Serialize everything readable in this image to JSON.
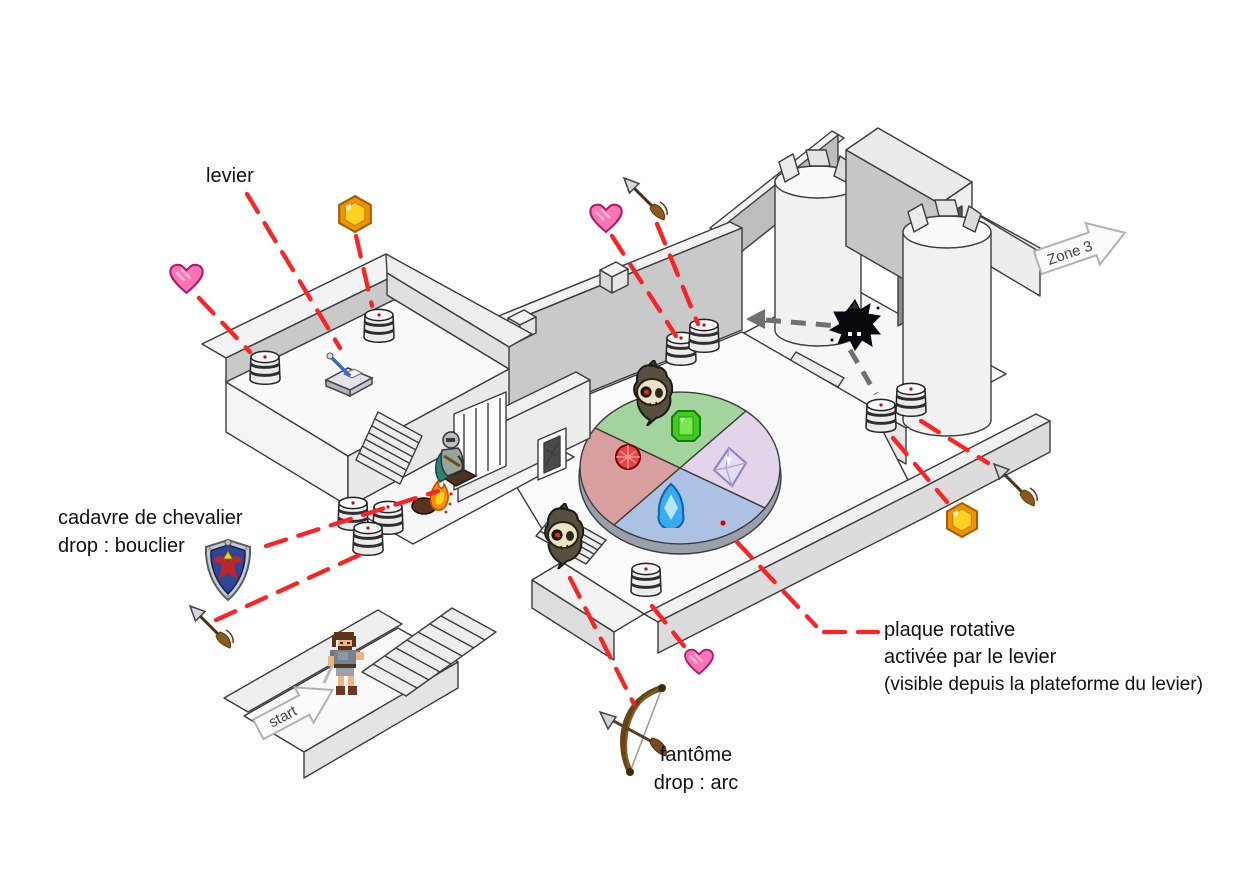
{
  "labels": {
    "lever_label": "levier",
    "knight_label_line1": "cadavre de chevalier",
    "knight_label_line2": "drop : bouclier",
    "ghost_label_line1": "fantôme",
    "ghost_label_line2": "drop : arc",
    "plate_label_line1": "plaque rotative",
    "plate_label_line2": "activée par le levier",
    "plate_label_line3": "(visible depuis la plateforme du levier)",
    "zone3_arrow": "Zone 3",
    "start_arrow": "start"
  },
  "colors": {
    "annotation_line": "#ff2222",
    "patrol": "#707070",
    "plate_red": "#d99f9f",
    "plate_green": "#a3d49d",
    "plate_blue": "#adc2e2",
    "plate_purple": "#e2d4eb",
    "heart": "#ff74b2",
    "gem": "#ffd21f"
  },
  "map_items": [
    {
      "type": "heart",
      "name": "heart-pickup-1",
      "x": 168,
      "y": 262,
      "w": 37,
      "h": 33
    },
    {
      "type": "heart",
      "name": "heart-pickup-2",
      "x": 588,
      "y": 202,
      "w": 36,
      "h": 32
    },
    {
      "type": "heart",
      "name": "heart-pickup-3",
      "x": 683,
      "y": 647,
      "w": 32,
      "h": 29
    },
    {
      "type": "gem",
      "name": "gem-pickup-1",
      "x": 337,
      "y": 195,
      "w": 36,
      "h": 38
    },
    {
      "type": "gem",
      "name": "gem-pickup-2",
      "x": 945,
      "y": 502,
      "w": 34,
      "h": 36
    },
    {
      "type": "arrow-item",
      "name": "arrow-pickup-1",
      "x": 186,
      "y": 602,
      "w": 50,
      "h": 50
    },
    {
      "type": "arrow-item",
      "name": "arrow-pickup-2",
      "x": 990,
      "y": 460,
      "w": 50,
      "h": 50
    },
    {
      "type": "arrow-item",
      "name": "arrow-pickup-3",
      "x": 620,
      "y": 174,
      "w": 50,
      "h": 50
    },
    {
      "type": "barrel",
      "name": "barrel-lever-room-left",
      "x": 248,
      "y": 350,
      "w": 34,
      "h": 40
    },
    {
      "type": "barrel",
      "name": "barrel-lever-room-right",
      "x": 362,
      "y": 308,
      "w": 34,
      "h": 40
    },
    {
      "type": "barrel",
      "name": "barrel-cache-1",
      "x": 336,
      "y": 496,
      "w": 34,
      "h": 40
    },
    {
      "type": "barrel",
      "name": "barrel-cache-2",
      "x": 371,
      "y": 500,
      "w": 34,
      "h": 40
    },
    {
      "type": "barrel",
      "name": "barrel-cache-3",
      "x": 351,
      "y": 521,
      "w": 34,
      "h": 40
    },
    {
      "type": "barrel",
      "name": "barrel-hall-1",
      "x": 664,
      "y": 331,
      "w": 34,
      "h": 40
    },
    {
      "type": "barrel",
      "name": "barrel-hall-2",
      "x": 687,
      "y": 318,
      "w": 34,
      "h": 40
    },
    {
      "type": "barrel",
      "name": "barrel-tower-1",
      "x": 864,
      "y": 398,
      "w": 34,
      "h": 40
    },
    {
      "type": "barrel",
      "name": "barrel-tower-2",
      "x": 894,
      "y": 382,
      "w": 34,
      "h": 40
    },
    {
      "type": "barrel",
      "name": "barrel-front",
      "x": 629,
      "y": 562,
      "w": 34,
      "h": 40
    },
    {
      "type": "ghost",
      "name": "ghost-hall-north",
      "x": 630,
      "y": 360,
      "w": 46,
      "h": 66
    },
    {
      "type": "ghost",
      "name": "ghost-hall-south",
      "x": 541,
      "y": 503,
      "w": 46,
      "h": 66
    },
    {
      "type": "black-ghost",
      "name": "shadow-ghost",
      "x": 826,
      "y": 294,
      "w": 58,
      "h": 58
    },
    {
      "type": "bow",
      "name": "bow-drop",
      "x": 596,
      "y": 680,
      "w": 86,
      "h": 108
    },
    {
      "type": "lever",
      "name": "lever-mechanism",
      "x": 318,
      "y": 350,
      "w": 62,
      "h": 48
    },
    {
      "type": "knight",
      "name": "knight-corpse",
      "x": 424,
      "y": 426,
      "w": 58,
      "h": 68
    },
    {
      "type": "fire",
      "name": "fire",
      "x": 410,
      "y": 476,
      "w": 44,
      "h": 40
    },
    {
      "type": "hero",
      "name": "player-start-hero",
      "x": 322,
      "y": 630,
      "w": 46,
      "h": 68
    },
    {
      "type": "ruby",
      "name": "plate-gem-ruby",
      "x": 614,
      "y": 443,
      "w": 28,
      "h": 28
    },
    {
      "type": "emerald",
      "name": "plate-gem-emerald",
      "x": 670,
      "y": 408,
      "w": 32,
      "h": 36
    },
    {
      "type": "diamond",
      "name": "plate-gem-diamond",
      "x": 712,
      "y": 446,
      "w": 36,
      "h": 42
    },
    {
      "type": "sapphire",
      "name": "plate-gem-sapphire",
      "x": 656,
      "y": 482,
      "w": 30,
      "h": 46
    },
    {
      "type": "shield",
      "name": "hylian-shield-drop",
      "x": 200,
      "y": 538,
      "w": 56,
      "h": 64,
      "layer": "top"
    }
  ],
  "annotation_lines": [
    [
      247,
      194,
      340,
      348
    ],
    [
      199,
      298,
      250,
      352
    ],
    [
      356,
      236,
      372,
      306
    ],
    [
      266,
      546,
      438,
      491
    ],
    [
      216,
      620,
      366,
      552
    ],
    [
      612,
      236,
      676,
      336
    ],
    [
      657,
      224,
      698,
      324
    ],
    [
      893,
      438,
      947,
      502
    ],
    [
      921,
      421,
      988,
      463
    ],
    [
      652,
      606,
      684,
      646
    ],
    [
      570,
      578,
      634,
      704
    ],
    [
      737,
      542,
      816,
      626
    ],
    [
      824,
      632,
      878,
      632
    ]
  ],
  "patrol_path": {
    "segments": [
      [
        766,
        320,
        838,
        326
      ],
      [
        850,
        350,
        876,
        394
      ]
    ],
    "arrowhead": "746,319 765,309 765,329"
  }
}
